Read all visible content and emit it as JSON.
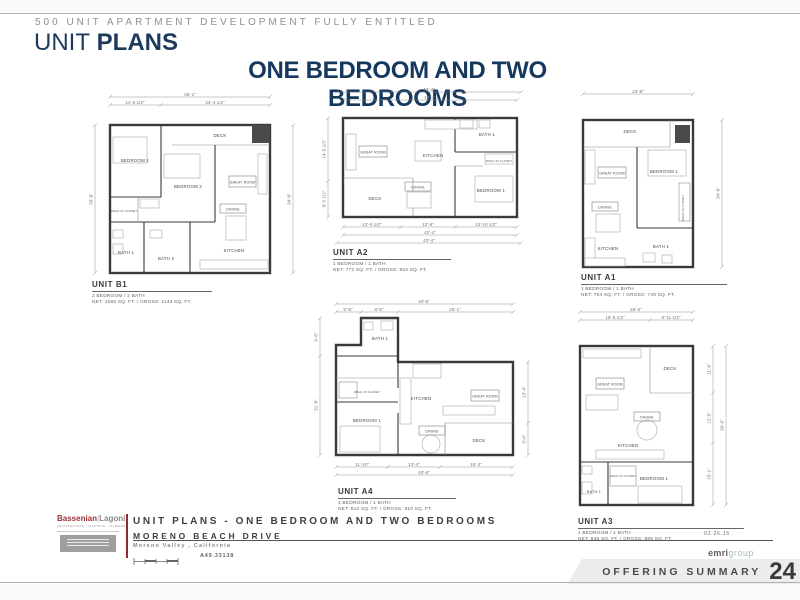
{
  "page": {
    "eyebrow": "500 UNIT APARTMENT DEVELOPMENT FULLY ENTITLED",
    "title_light": "UNIT",
    "title_bold": "PLANS",
    "subtitle": "ONE BEDROOM AND TWO BEDROOMS"
  },
  "units": [
    {
      "id": "B1",
      "name": "UNIT B1",
      "beds_baths": "2 BEDROOM / 2 BATH",
      "area": "NET: 1096 SQ. FT. / GROSS: 1143 SQ. FT.",
      "dims": {
        "overall_top": "36'-1\"",
        "top_a": "11'-6 1/2\"",
        "top_b": "24'-4 1/2\"",
        "left": "33'-8\"",
        "right": "34'-8\""
      },
      "rooms": {
        "bedroom1": "BEDROOM 1",
        "bedroom2": "BEDROOM 2",
        "great_room": "GREAT ROOM",
        "dining": "DINING",
        "kitchen": "KITCHEN",
        "bath1": "BATH 1",
        "bath2": "BATH 2",
        "deck": "DECK",
        "wic": "WALK-IN CLOSET"
      }
    },
    {
      "id": "A2",
      "name": "UNIT A2",
      "beds_baths": "1 BEDROOM / 1 BATH",
      "area": "NET: 772 SQ. FT. / GROSS: 834 SQ. FT.",
      "dims": {
        "top_outer": "43'-4\"",
        "top_inner": "42'-4\"",
        "left_a": "14'-5 1/2\"",
        "left_b": "8'-5 1/2\"",
        "bot_a": "13'-9 1/2\"",
        "bot_b": "12'-8\"",
        "bot_c": "13'-10 1/2\"",
        "bot_inner": "42'-4\"",
        "bot_outer": "43'-4\""
      },
      "rooms": {
        "great_room": "GREAT ROOM",
        "kitchen": "KITCHEN",
        "dining": "DINING",
        "deck": "DECK",
        "bath1": "BATH 1",
        "bedroom1": "BEDROOM 1",
        "wic": "WALK-IN CLOSET"
      }
    },
    {
      "id": "A1",
      "name": "UNIT A1",
      "beds_baths": "1 BEDROOM / 1 BATH",
      "area": "NET: 704 SQ. FT. / GROSS: 749 SQ. FT.",
      "dims": {
        "top": "23'-8\"",
        "right": "34'-8\""
      },
      "rooms": {
        "deck": "DECK",
        "great_room": "GREAT ROOM",
        "bedroom1": "BEDROOM 1",
        "dining": "DINING",
        "kitchen": "KITCHEN",
        "bath1": "BATH 1",
        "wic": "WALK-IN CLOSET"
      }
    },
    {
      "id": "A4",
      "name": "UNIT A4",
      "beds_baths": "1 BEDROOM / 1 BATH",
      "area": "NET: 812 SQ. FT. / GROSS: 910 SQ. FT.",
      "dims": {
        "overall_top": "40'-5\"",
        "top_a": "5'-8\"",
        "top_b": "8'-5\"",
        "top_c": "26'-1\"",
        "left_a": "5'-8\"",
        "left_b": "31'-8\"",
        "right_a": "13'-4\"",
        "right_b": "8'-0\"",
        "bot_a": "11'-10\"",
        "bot_b": "13'-4\"",
        "bot_c": "15'-3\"",
        "overall_bot": "40'-5\""
      },
      "rooms": {
        "bath1": "BATH 1",
        "wic": "WALK-IN CLOSET",
        "bedroom1": "BEDROOM 1",
        "kitchen": "KITCHEN",
        "dining": "DINING",
        "great_room": "GREAT ROOM",
        "deck": "DECK"
      }
    },
    {
      "id": "A3",
      "name": "UNIT A3",
      "beds_baths": "1 BEDROOM / 1 BATH",
      "area": "NET: 836 SQ. FT. / GROSS: 889 SQ. FT.",
      "dims": {
        "overall_top": "26'-5\"",
        "top_a": "16'-5 1/2\"",
        "top_b": "9'-11 1/2\"",
        "right_a": "11'-6\"",
        "right_b": "12'-5\"",
        "right_c": "15'-1\"",
        "overall_right": "39'-0\""
      },
      "rooms": {
        "great_room": "GREAT ROOM",
        "deck": "DECK",
        "dining": "DINING",
        "kitchen": "KITCHEN",
        "bath1": "BATH 1",
        "bedroom1": "BEDROOM 1",
        "wic": "WALK-IN CLOSET"
      }
    }
  ],
  "footer": {
    "architect": {
      "brand_left": "Bassenian",
      "brand_sep": "|",
      "brand_right": "Lagoni",
      "tagline": "ARCHITECTURE · PLANNING · INTERIORS"
    },
    "project_title": "UNIT PLANS - ONE BEDROOM AND TWO BEDROOMS",
    "street": "MORENO BEACH DRIVE",
    "city": "Moreno Valley , California",
    "job_number": "A49.33138",
    "date": "03.26.15",
    "publisher": {
      "bold": "emri",
      "light": "group"
    },
    "banner": {
      "label": "OFFERING SUMMARY",
      "page_number": "24"
    }
  },
  "colors": {
    "navy": "#1c3a5c",
    "brand_red": "#9b3136",
    "maroon_rule": "#8e2b33",
    "sage": "#a9bfae",
    "banner_bg": "#ececec"
  }
}
